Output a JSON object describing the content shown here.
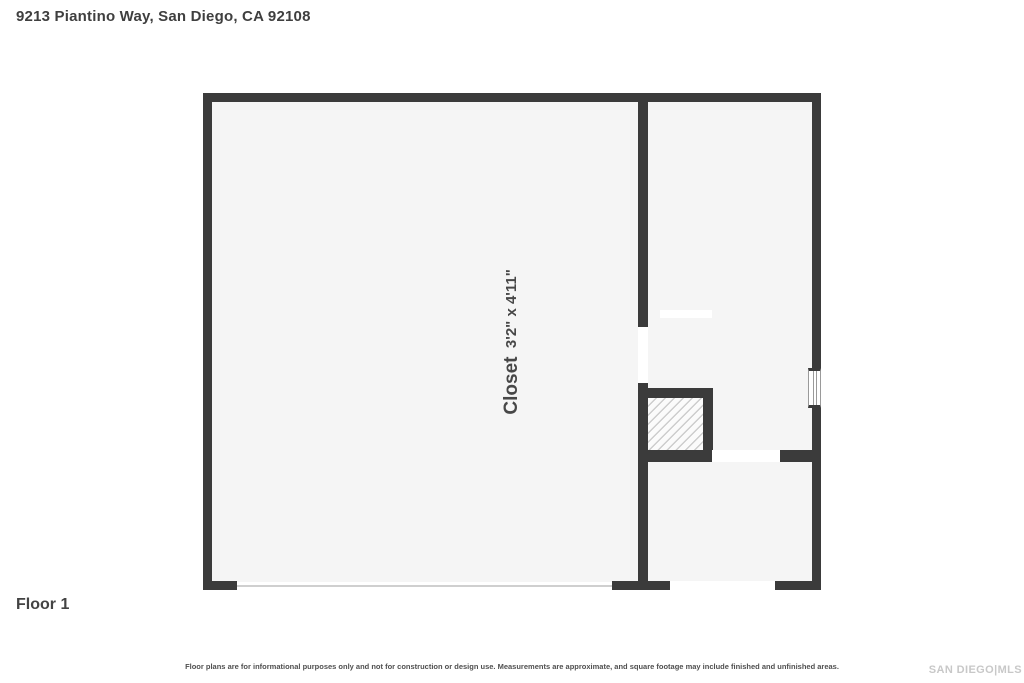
{
  "header": {
    "title": "9213 Piantino Way, San Diego, CA 92108"
  },
  "floorplan": {
    "rooms": {
      "garage": {
        "label": "Garage",
        "dims": "18'2\" x 20'5\""
      },
      "stairs": {
        "label": "Stairs (Up)"
      },
      "closet": {
        "label": "Closet",
        "dims": "3'2\" x 4'11\""
      },
      "foyer": {
        "label": "Foyer",
        "dims": "7'0\" x 5'8\""
      },
      "entry": {
        "label": "Entry"
      },
      "front_porch": {
        "label": "Front Porch",
        "dims": "7'4\" x 5'2\""
      }
    }
  },
  "footer": {
    "floor_label": "Floor 1",
    "disclaimer": "Floor plans are for informational purposes only and not for construction or design use. Measurements are approximate, and square footage may include finished and unfinished areas.",
    "watermark": "SAN DIEGO|MLS"
  },
  "colors": {
    "wall": "#3b3b3b",
    "room_fill": "#f4f4f4",
    "hatch_line": "#cdcdcd",
    "tile_line": "#e0e0e0",
    "label_text": "#474747",
    "entry_arrow": "#b5b5b5",
    "watermark": "#c8c8c8"
  }
}
